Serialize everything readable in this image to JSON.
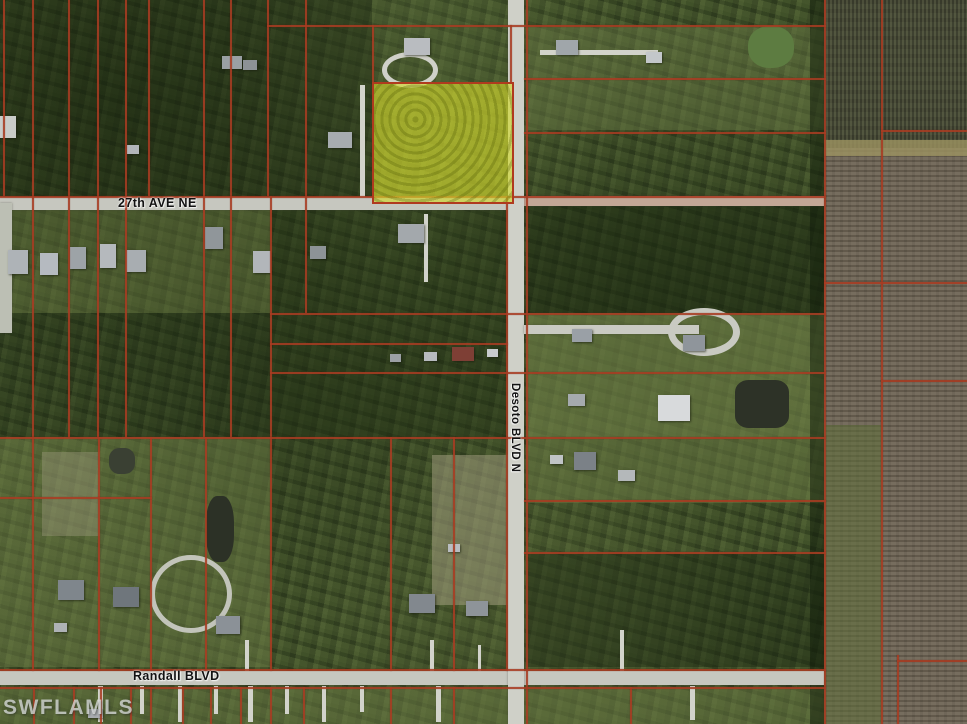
{
  "map": {
    "watermark": "SWFLAMLS",
    "labels": {
      "ave27": "27th AVE NE",
      "desoto": "Desoto BLVD N",
      "randall": "Randall BLVD"
    },
    "colors": {
      "parcel_line": "#a83c22",
      "road_paved": "#c6c7bf",
      "road_dirt": "#c3a796",
      "highlight_fill": "rgba(208,214,40,0.55)",
      "highlight_border": "#b03a1e",
      "vegetation_base": "#43532c",
      "farm_base": "#6f6555",
      "farm_dark": "#4c4f3a",
      "pond_dark": "#2d3227",
      "pond_green": "#5d7c41"
    },
    "highlight_parcel": {
      "x": 372,
      "y": 82,
      "w": 138,
      "h": 118
    },
    "zones": [
      {
        "name": "forest-top-left",
        "x": 0,
        "y": 0,
        "w": 372,
        "h": 196,
        "color": "rgba(22,34,14,0.35)"
      },
      {
        "name": "open-left-mid",
        "x": 0,
        "y": 203,
        "w": 270,
        "h": 110,
        "color": "rgba(104,120,66,0.40)"
      },
      {
        "name": "forest-left-lower",
        "x": 0,
        "y": 313,
        "w": 270,
        "h": 124,
        "color": "rgba(24,36,16,0.30)"
      },
      {
        "name": "forest-mid",
        "x": 272,
        "y": 203,
        "w": 234,
        "h": 234,
        "color": "rgba(28,42,18,0.35)"
      },
      {
        "name": "open-top-right",
        "x": 526,
        "y": 27,
        "w": 298,
        "h": 103,
        "color": "rgba(110,126,72,0.40)"
      },
      {
        "name": "forest-east-upper",
        "x": 526,
        "y": 203,
        "w": 298,
        "h": 110,
        "color": "rgba(20,32,12,0.40)"
      },
      {
        "name": "open-east-mid",
        "x": 526,
        "y": 313,
        "w": 298,
        "h": 124,
        "color": "rgba(122,138,78,0.55)"
      },
      {
        "name": "open-east-low",
        "x": 526,
        "y": 437,
        "w": 298,
        "h": 66,
        "color": "rgba(118,134,76,0.45)"
      },
      {
        "name": "forest-east-lower",
        "x": 526,
        "y": 554,
        "w": 298,
        "h": 113,
        "color": "rgba(22,34,14,0.40)"
      },
      {
        "name": "open-bottom-left",
        "x": 0,
        "y": 437,
        "w": 270,
        "h": 230,
        "color": "rgba(112,128,74,0.45)"
      },
      {
        "name": "sand-mid-south",
        "x": 432,
        "y": 455,
        "w": 76,
        "h": 150,
        "color": "rgba(168,162,132,0.50)"
      },
      {
        "name": "sand-left",
        "x": 42,
        "y": 452,
        "w": 58,
        "h": 84,
        "color": "rgba(160,155,128,0.40)"
      },
      {
        "name": "open-below-randall",
        "x": 0,
        "y": 688,
        "w": 824,
        "h": 36,
        "color": "rgba(110,126,72,0.45)"
      },
      {
        "name": "hedge-farm-edge",
        "x": 810,
        "y": 0,
        "w": 16,
        "h": 724,
        "color": "rgba(16,28,10,0.50)"
      },
      {
        "name": "farm-field",
        "x": 824,
        "y": 0,
        "w": 143,
        "h": 724,
        "color": "#6f6555",
        "texture": "farm"
      },
      {
        "name": "farm-field-north",
        "x": 824,
        "y": 0,
        "w": 143,
        "h": 148,
        "color": "#4c4f3a",
        "texture": "farm-dark"
      },
      {
        "name": "farm-track",
        "x": 824,
        "y": 140,
        "w": 143,
        "h": 16,
        "color": "rgba(156,146,96,0.8)"
      },
      {
        "name": "farm-green-strip",
        "x": 824,
        "y": 425,
        "w": 58,
        "h": 299,
        "color": "rgba(94,112,58,0.55)"
      }
    ],
    "ponds": [
      {
        "name": "pond-green-topright",
        "x": 748,
        "y": 26,
        "w": 46,
        "h": 42,
        "color": "#5d7c41",
        "r": "45%"
      },
      {
        "name": "pond-dark-east",
        "x": 735,
        "y": 380,
        "w": 54,
        "h": 48,
        "color": "#2d3227",
        "r": "25%"
      },
      {
        "name": "pond-dark-left",
        "x": 206,
        "y": 496,
        "w": 28,
        "h": 66,
        "color": "#2c3126",
        "r": "40%"
      },
      {
        "name": "pond-small-left",
        "x": 109,
        "y": 448,
        "w": 26,
        "h": 26,
        "color": "#3a4033",
        "r": "40%"
      }
    ],
    "roads": [
      {
        "name": "road-27th-ave-ne-west",
        "x": 0,
        "y": 197,
        "w": 510,
        "h": 13,
        "color": "#c6c7bf"
      },
      {
        "name": "road-27th-ave-ne-east",
        "x": 510,
        "y": 196,
        "w": 314,
        "h": 10,
        "color": "#c3a796"
      },
      {
        "name": "road-randall-blvd",
        "x": 0,
        "y": 671,
        "w": 824,
        "h": 14,
        "color": "#c6c7bf"
      },
      {
        "name": "road-desoto-blvd-n",
        "x": 508,
        "y": 0,
        "w": 16,
        "h": 724,
        "color": "#cfd0c8"
      },
      {
        "name": "road-east-court",
        "x": 524,
        "y": 325,
        "w": 175,
        "h": 9,
        "color": "#c9cac2"
      },
      {
        "name": "road-left-edge",
        "x": 0,
        "y": 203,
        "w": 12,
        "h": 130,
        "color": "#bcbfb4"
      }
    ],
    "driveways": [
      {
        "x": 360,
        "y": 85,
        "w": 5,
        "h": 112
      },
      {
        "x": 424,
        "y": 214,
        "w": 4,
        "h": 68
      },
      {
        "x": 540,
        "y": 50,
        "w": 118,
        "h": 5
      },
      {
        "x": 98,
        "y": 686,
        "w": 5,
        "h": 36
      },
      {
        "x": 140,
        "y": 686,
        "w": 4,
        "h": 28
      },
      {
        "x": 178,
        "y": 686,
        "w": 4,
        "h": 36
      },
      {
        "x": 214,
        "y": 686,
        "w": 4,
        "h": 28
      },
      {
        "x": 248,
        "y": 686,
        "w": 5,
        "h": 36
      },
      {
        "x": 285,
        "y": 686,
        "w": 4,
        "h": 28
      },
      {
        "x": 322,
        "y": 686,
        "w": 4,
        "h": 36
      },
      {
        "x": 360,
        "y": 686,
        "w": 4,
        "h": 26
      },
      {
        "x": 436,
        "y": 686,
        "w": 5,
        "h": 36
      },
      {
        "x": 690,
        "y": 686,
        "w": 5,
        "h": 34
      },
      {
        "x": 245,
        "y": 640,
        "w": 4,
        "h": 31
      },
      {
        "x": 430,
        "y": 640,
        "w": 4,
        "h": 31
      },
      {
        "x": 478,
        "y": 645,
        "w": 3,
        "h": 26
      },
      {
        "x": 620,
        "y": 630,
        "w": 4,
        "h": 41
      }
    ],
    "loop_drives": [
      {
        "name": "culdesac-east",
        "x": 668,
        "y": 308,
        "w": 58,
        "h": 34,
        "border": "7px solid #c9cac2"
      },
      {
        "name": "loop-top-house",
        "x": 382,
        "y": 52,
        "w": 46,
        "h": 26,
        "border": "5px solid #cfd0c8"
      },
      {
        "name": "loop-bottom-left",
        "x": 150,
        "y": 555,
        "w": 72,
        "h": 68,
        "border": "5px solid #c2c4ba"
      }
    ],
    "structures": [
      {
        "x": 404,
        "y": 38,
        "w": 26,
        "h": 17,
        "color": "#b9bcc0"
      },
      {
        "x": 222,
        "y": 56,
        "w": 20,
        "h": 13,
        "color": "#9aa0a4"
      },
      {
        "x": 243,
        "y": 60,
        "w": 14,
        "h": 10,
        "color": "#8d9296"
      },
      {
        "x": 328,
        "y": 132,
        "w": 24,
        "h": 16,
        "color": "#a7acb0"
      },
      {
        "x": 127,
        "y": 145,
        "w": 12,
        "h": 9,
        "color": "#b2b6ba"
      },
      {
        "x": 556,
        "y": 40,
        "w": 22,
        "h": 15,
        "color": "#a0a6aa"
      },
      {
        "x": 646,
        "y": 52,
        "w": 16,
        "h": 11,
        "color": "#c3c7ca"
      },
      {
        "x": 0,
        "y": 116,
        "w": 16,
        "h": 22,
        "color": "#c9ccc9"
      },
      {
        "x": 8,
        "y": 250,
        "w": 20,
        "h": 24,
        "color": "#aeb3b7"
      },
      {
        "x": 40,
        "y": 253,
        "w": 18,
        "h": 22,
        "color": "#b5bac0"
      },
      {
        "x": 70,
        "y": 247,
        "w": 16,
        "h": 22,
        "color": "#9da3a7"
      },
      {
        "x": 100,
        "y": 244,
        "w": 16,
        "h": 24,
        "color": "#b5b9bd"
      },
      {
        "x": 126,
        "y": 250,
        "w": 20,
        "h": 22,
        "color": "#a8adb1"
      },
      {
        "x": 205,
        "y": 227,
        "w": 18,
        "h": 22,
        "color": "#90969a"
      },
      {
        "x": 253,
        "y": 251,
        "w": 18,
        "h": 22,
        "color": "#b2b6ba"
      },
      {
        "x": 310,
        "y": 246,
        "w": 16,
        "h": 13,
        "color": "#8d9397"
      },
      {
        "x": 398,
        "y": 224,
        "w": 26,
        "h": 19,
        "color": "#a3a8ac"
      },
      {
        "x": 452,
        "y": 347,
        "w": 22,
        "h": 14,
        "color": "#7e3f35"
      },
      {
        "x": 424,
        "y": 352,
        "w": 13,
        "h": 9,
        "color": "#b7bbbf"
      },
      {
        "x": 487,
        "y": 349,
        "w": 11,
        "h": 8,
        "color": "#c8cbce"
      },
      {
        "x": 390,
        "y": 354,
        "w": 11,
        "h": 8,
        "color": "#9ba0a4"
      },
      {
        "x": 572,
        "y": 329,
        "w": 20,
        "h": 13,
        "color": "#9aa0a6"
      },
      {
        "x": 683,
        "y": 335,
        "w": 22,
        "h": 16,
        "color": "#8f959b"
      },
      {
        "x": 568,
        "y": 394,
        "w": 17,
        "h": 12,
        "color": "#a5aaae"
      },
      {
        "x": 658,
        "y": 395,
        "w": 32,
        "h": 26,
        "color": "#d8dadc"
      },
      {
        "x": 574,
        "y": 452,
        "w": 22,
        "h": 18,
        "color": "#7b8187"
      },
      {
        "x": 550,
        "y": 455,
        "w": 13,
        "h": 9,
        "color": "#c0c4c6"
      },
      {
        "x": 618,
        "y": 470,
        "w": 17,
        "h": 11,
        "color": "#b4b8ba"
      },
      {
        "x": 58,
        "y": 580,
        "w": 26,
        "h": 20,
        "color": "#7f868c"
      },
      {
        "x": 113,
        "y": 587,
        "w": 26,
        "h": 20,
        "color": "#6f767c"
      },
      {
        "x": 54,
        "y": 623,
        "w": 13,
        "h": 9,
        "color": "#aeb2b6"
      },
      {
        "x": 216,
        "y": 616,
        "w": 24,
        "h": 18,
        "color": "#8b9197"
      },
      {
        "x": 409,
        "y": 594,
        "w": 26,
        "h": 19,
        "color": "#82888e"
      },
      {
        "x": 466,
        "y": 601,
        "w": 22,
        "h": 15,
        "color": "#8e9499"
      },
      {
        "x": 448,
        "y": 544,
        "w": 12,
        "h": 8,
        "color": "#b9bdc1"
      },
      {
        "x": 88,
        "y": 709,
        "w": 15,
        "h": 9,
        "color": "#a9adb1"
      }
    ],
    "parcel_lines": [
      {
        "x": 3,
        "y": 0,
        "w": 2,
        "h": 196
      },
      {
        "x": 32,
        "y": 0,
        "w": 2,
        "h": 196
      },
      {
        "x": 68,
        "y": 0,
        "w": 2,
        "h": 196
      },
      {
        "x": 97,
        "y": 0,
        "w": 2,
        "h": 196
      },
      {
        "x": 125,
        "y": 0,
        "w": 2,
        "h": 196
      },
      {
        "x": 148,
        "y": 0,
        "w": 2,
        "h": 196
      },
      {
        "x": 203,
        "y": 0,
        "w": 2,
        "h": 196
      },
      {
        "x": 230,
        "y": 0,
        "w": 2,
        "h": 196
      },
      {
        "x": 267,
        "y": 0,
        "w": 2,
        "h": 196
      },
      {
        "x": 305,
        "y": 0,
        "w": 2,
        "h": 196
      },
      {
        "x": 372,
        "y": 25,
        "w": 2,
        "h": 57
      },
      {
        "x": 510,
        "y": 25,
        "w": 2,
        "h": 57
      },
      {
        "x": 32,
        "y": 196,
        "w": 2,
        "h": 241
      },
      {
        "x": 68,
        "y": 196,
        "w": 2,
        "h": 241
      },
      {
        "x": 97,
        "y": 196,
        "w": 2,
        "h": 241
      },
      {
        "x": 125,
        "y": 196,
        "w": 2,
        "h": 241
      },
      {
        "x": 203,
        "y": 196,
        "w": 2,
        "h": 241
      },
      {
        "x": 230,
        "y": 196,
        "w": 2,
        "h": 241
      },
      {
        "x": 270,
        "y": 196,
        "w": 2,
        "h": 241
      },
      {
        "x": 305,
        "y": 196,
        "w": 2,
        "h": 117
      },
      {
        "x": 32,
        "y": 437,
        "w": 2,
        "h": 234
      },
      {
        "x": 98,
        "y": 437,
        "w": 2,
        "h": 234
      },
      {
        "x": 150,
        "y": 437,
        "w": 2,
        "h": 234
      },
      {
        "x": 205,
        "y": 437,
        "w": 2,
        "h": 234
      },
      {
        "x": 270,
        "y": 437,
        "w": 2,
        "h": 234
      },
      {
        "x": 390,
        "y": 437,
        "w": 2,
        "h": 234
      },
      {
        "x": 453,
        "y": 437,
        "w": 2,
        "h": 234
      },
      {
        "x": 506,
        "y": 196,
        "w": 2,
        "h": 475
      },
      {
        "x": 526,
        "y": 0,
        "w": 2,
        "h": 724
      },
      {
        "x": 824,
        "y": 0,
        "w": 2,
        "h": 724
      },
      {
        "x": 881,
        "y": 0,
        "w": 2,
        "h": 724
      },
      {
        "x": 897,
        "y": 655,
        "w": 2,
        "h": 69
      },
      {
        "x": 33,
        "y": 687,
        "w": 2,
        "h": 37
      },
      {
        "x": 73,
        "y": 687,
        "w": 2,
        "h": 37
      },
      {
        "x": 100,
        "y": 687,
        "w": 2,
        "h": 37
      },
      {
        "x": 130,
        "y": 687,
        "w": 2,
        "h": 37
      },
      {
        "x": 150,
        "y": 687,
        "w": 2,
        "h": 37
      },
      {
        "x": 182,
        "y": 687,
        "w": 2,
        "h": 37
      },
      {
        "x": 210,
        "y": 687,
        "w": 2,
        "h": 37
      },
      {
        "x": 240,
        "y": 687,
        "w": 2,
        "h": 37
      },
      {
        "x": 270,
        "y": 687,
        "w": 2,
        "h": 37
      },
      {
        "x": 303,
        "y": 687,
        "w": 2,
        "h": 37
      },
      {
        "x": 390,
        "y": 687,
        "w": 2,
        "h": 37
      },
      {
        "x": 453,
        "y": 687,
        "w": 2,
        "h": 37
      },
      {
        "x": 630,
        "y": 687,
        "w": 2,
        "h": 37
      },
      {
        "x": 267,
        "y": 25,
        "w": 559,
        "h": 2
      },
      {
        "x": 524,
        "y": 78,
        "w": 302,
        "h": 2
      },
      {
        "x": 524,
        "y": 132,
        "w": 302,
        "h": 2
      },
      {
        "x": 881,
        "y": 130,
        "w": 86,
        "h": 2
      },
      {
        "x": 0,
        "y": 196,
        "w": 826,
        "h": 2
      },
      {
        "x": 270,
        "y": 313,
        "w": 556,
        "h": 2
      },
      {
        "x": 270,
        "y": 343,
        "w": 238,
        "h": 2
      },
      {
        "x": 270,
        "y": 372,
        "w": 556,
        "h": 2
      },
      {
        "x": 0,
        "y": 437,
        "w": 826,
        "h": 2
      },
      {
        "x": 524,
        "y": 500,
        "w": 302,
        "h": 2
      },
      {
        "x": 524,
        "y": 552,
        "w": 302,
        "h": 2
      },
      {
        "x": 824,
        "y": 282,
        "w": 143,
        "h": 2
      },
      {
        "x": 881,
        "y": 380,
        "w": 86,
        "h": 2
      },
      {
        "x": 0,
        "y": 497,
        "w": 152,
        "h": 2
      },
      {
        "x": 0,
        "y": 669,
        "w": 826,
        "h": 2
      },
      {
        "x": 0,
        "y": 687,
        "w": 826,
        "h": 2
      },
      {
        "x": 897,
        "y": 660,
        "w": 70,
        "h": 2
      }
    ]
  }
}
